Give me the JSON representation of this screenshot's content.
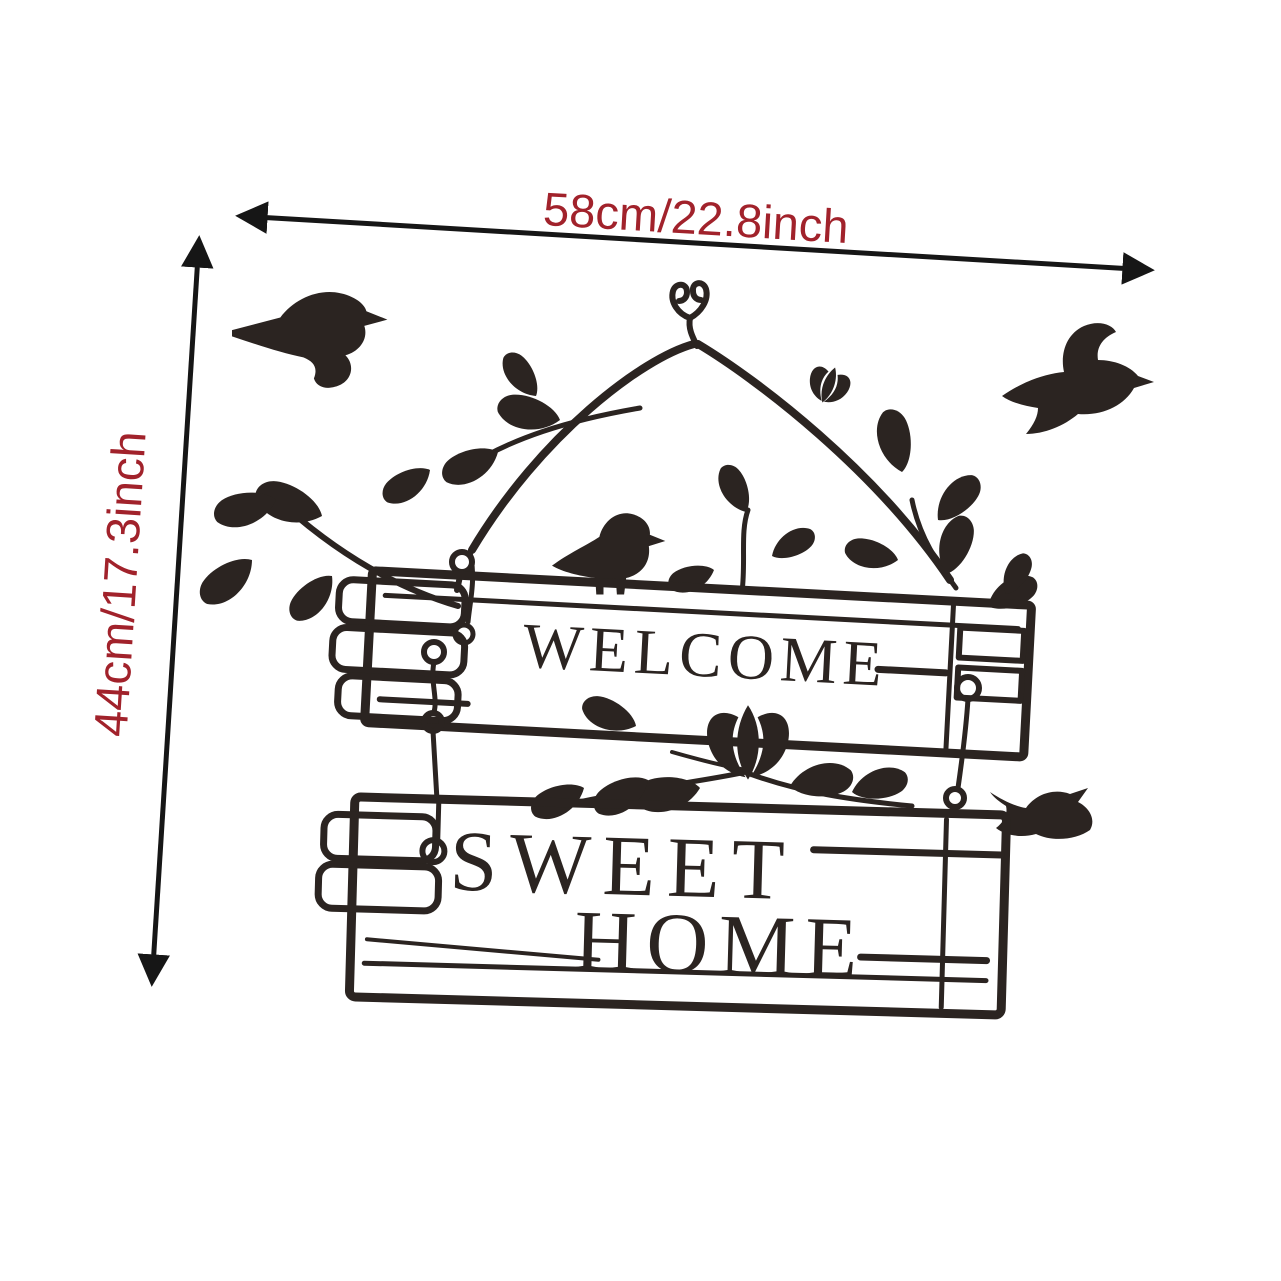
{
  "page": {
    "background_color": "#ffffff",
    "type": "product-dimension-diagram"
  },
  "dimensions": {
    "width_label": "58cm/22.8inch",
    "height_label": "44cm/17.3inch",
    "label_color": "#a1222b",
    "arrow_color": "#161616"
  },
  "decal": {
    "ink_color": "#2b2421",
    "board1_text": "WELCOME",
    "board2_line1": "SWEET",
    "board2_line2": "HOME",
    "motifs": [
      "hanging-hook",
      "hanging-cords",
      "flying-bird-left",
      "flying-bird-right",
      "perched-bird",
      "small-bird-right",
      "leaf-branches",
      "tulip-flower",
      "chain-rings",
      "wood-plank-boards"
    ]
  }
}
